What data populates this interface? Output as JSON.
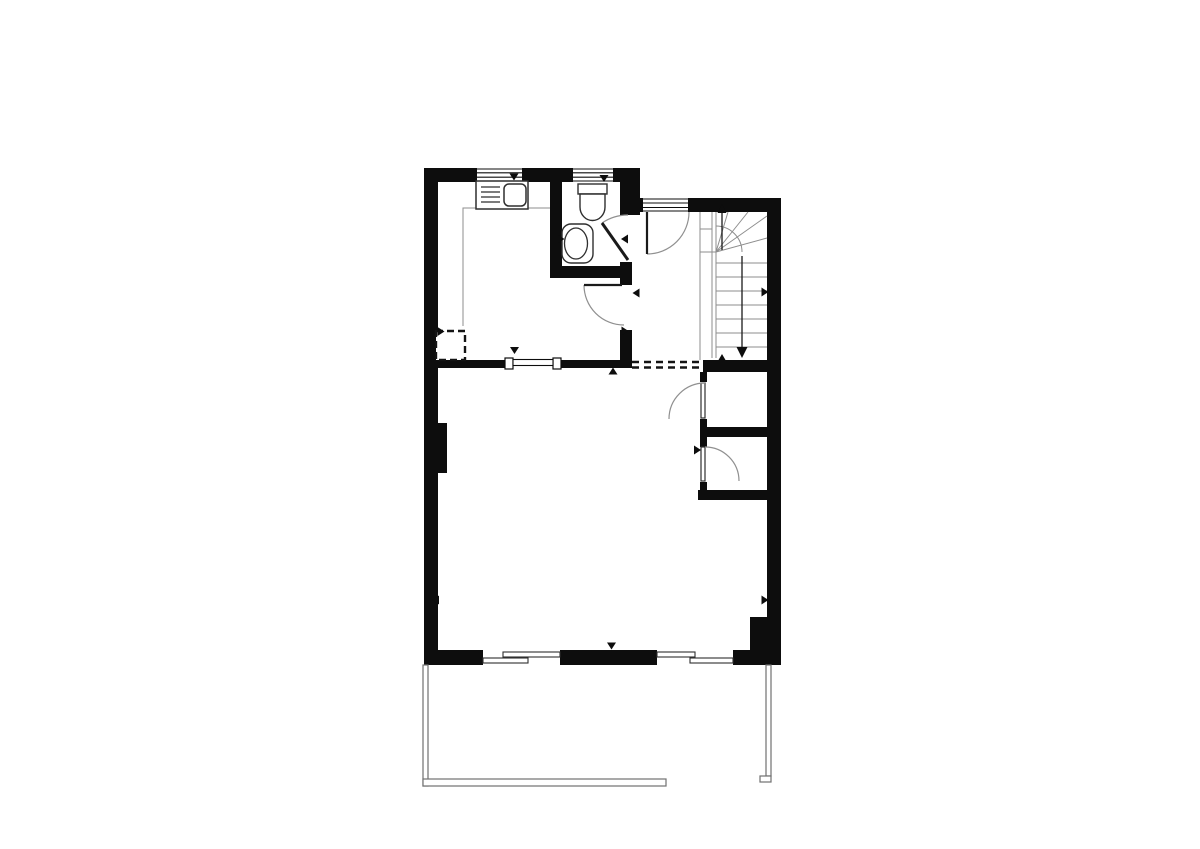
{
  "canvas": {
    "width": 1200,
    "height": 849,
    "background": "#ffffff"
  },
  "colors": {
    "wall": "#0d0d0d",
    "fixture": "#2f2f2f",
    "leaf": "#1a1a1a",
    "thin": "#8d8d8d",
    "arc": "#909090",
    "rail": "#707070",
    "dash": "#141414",
    "white": "#ffffff"
  },
  "floorplan": {
    "elements": [
      {
        "t": "rect",
        "n": "top-wall",
        "x": 424,
        "y": 168,
        "w": 214,
        "h": 14
      },
      {
        "t": "rect",
        "n": "left-wall",
        "x": 424,
        "y": 168,
        "w": 14,
        "h": 497
      },
      {
        "t": "rect",
        "n": "entry-junction-column",
        "x": 630,
        "y": 168,
        "w": 10,
        "h": 47
      },
      {
        "t": "rect",
        "n": "hallway-top-wall",
        "x": 640,
        "y": 198,
        "w": 141,
        "h": 14
      },
      {
        "t": "rect",
        "n": "right-wall",
        "x": 767,
        "y": 198,
        "w": 14,
        "h": 467
      },
      {
        "t": "rect",
        "n": "bottom-wall",
        "x": 424,
        "y": 650,
        "w": 357,
        "h": 15
      },
      {
        "t": "rect",
        "n": "corner-block",
        "x": 750,
        "y": 617,
        "w": 31,
        "h": 48
      },
      {
        "t": "rect",
        "n": "bathroom-left-wall",
        "x": 550,
        "y": 182,
        "w": 12,
        "h": 96
      },
      {
        "t": "rect",
        "n": "bathroom-bottom-wall",
        "x": 550,
        "y": 266,
        "w": 82,
        "h": 12
      },
      {
        "t": "rect",
        "n": "bathroom-right-wall",
        "x": 620,
        "y": 182,
        "w": 12,
        "h": 33
      },
      {
        "t": "rect",
        "n": "kitchen-hall-wall",
        "x": 620,
        "y": 262,
        "w": 12,
        "h": 100
      },
      {
        "t": "rect",
        "n": "kitchen-living-wall",
        "x": 424,
        "y": 360,
        "w": 208,
        "h": 8
      },
      {
        "t": "rect",
        "n": "stairs-bottom-wall",
        "x": 703,
        "y": 360,
        "w": 78,
        "h": 12
      },
      {
        "t": "rect",
        "n": "closet-left-wall",
        "x": 700,
        "y": 372,
        "w": 7,
        "h": 128
      },
      {
        "t": "rect",
        "n": "closet-mid-wall",
        "x": 700,
        "y": 427,
        "w": 67,
        "h": 10
      },
      {
        "t": "rect",
        "n": "closet-bottom-wall",
        "x": 698,
        "y": 490,
        "w": 69,
        "h": 10
      },
      {
        "t": "rect",
        "n": "left-wall-pier",
        "x": 433,
        "y": 423,
        "w": 14,
        "h": 50
      },
      {
        "t": "rect",
        "n": "window-1-gap",
        "x": 477,
        "y": 168,
        "w": 45,
        "h": 14,
        "f": "white"
      },
      {
        "t": "rect",
        "n": "window-2-gap",
        "x": 573,
        "y": 168,
        "w": 40,
        "h": 14,
        "f": "white"
      },
      {
        "t": "rect",
        "n": "entry-door-gap",
        "x": 643,
        "y": 198,
        "w": 45,
        "h": 14,
        "f": "white"
      },
      {
        "t": "rect",
        "n": "kitchen-opening-gap",
        "x": 505,
        "y": 360,
        "w": 56,
        "h": 8,
        "f": "white"
      },
      {
        "t": "rect",
        "n": "slider-1-gap",
        "x": 483,
        "y": 650,
        "w": 77,
        "h": 15,
        "f": "white"
      },
      {
        "t": "rect",
        "n": "slider-2-gap",
        "x": 657,
        "y": 650,
        "w": 76,
        "h": 15,
        "f": "white"
      },
      {
        "t": "rect",
        "n": "bathroom-door-gap",
        "x": 618,
        "y": 215,
        "w": 16,
        "h": 47,
        "f": "white"
      },
      {
        "t": "rect",
        "n": "hall-door-gap",
        "x": 618,
        "y": 285,
        "w": 16,
        "h": 45,
        "f": "white"
      },
      {
        "t": "rect",
        "n": "upper-closet-door-gap",
        "x": 698,
        "y": 382,
        "w": 11,
        "h": 37,
        "f": "white"
      },
      {
        "t": "rect",
        "n": "lower-closet-door-gap",
        "x": 698,
        "y": 447,
        "w": 11,
        "h": 35,
        "f": "white"
      },
      {
        "t": "path",
        "n": "window-1-frame",
        "d": "M477,169 H522 M477,181 H522 M477,172.8 H522 M477,177.2 H522",
        "s": "wall",
        "sw": 1.1
      },
      {
        "t": "path",
        "n": "window-2-frame",
        "d": "M573,169 H613 M573,181 H613 M573,172.8 H613 M573,177.2 H613",
        "s": "wall",
        "sw": 1.1
      },
      {
        "t": "path",
        "n": "entry-door-threshold",
        "d": "M643,199 H688 M643,211 H688 M643,203 H688 M643,207.5 H688",
        "s": "wall",
        "sw": 1.1
      },
      {
        "t": "rect",
        "n": "kitchen-opening-cap-left",
        "x": 505,
        "y": 358,
        "w": 8,
        "h": 11,
        "f": "white",
        "s": "wall",
        "sw": 1.2
      },
      {
        "t": "rect",
        "n": "kitchen-opening-cap-right",
        "x": 553,
        "y": 358,
        "w": 8,
        "h": 11,
        "f": "white",
        "s": "wall",
        "sw": 1.2
      },
      {
        "t": "rect",
        "n": "kitchen-opening-rail",
        "x": 513,
        "y": 359.5,
        "w": 40,
        "h": 6,
        "f": "white",
        "s": "wall",
        "sw": 1.1
      },
      {
        "t": "path",
        "n": "kitchen-zone-line",
        "d": "M463,326 V208 H550",
        "s": "thin",
        "sw": 1
      },
      {
        "t": "rect",
        "n": "kitchen-sink-unit",
        "x": 476,
        "y": 181,
        "w": 52,
        "h": 28,
        "f": "white",
        "s": "fixture",
        "sw": 1.5
      },
      {
        "t": "path",
        "n": "sink-drainer-lines",
        "d": "M481,187 H500 M481,192 H500 M481,197 H500 M481,202 H500",
        "s": "fixture",
        "sw": 1.3
      },
      {
        "t": "rect",
        "n": "sink-basin",
        "x": 504,
        "y": 184,
        "w": 22,
        "h": 22,
        "rx": 5,
        "f": "white",
        "s": "fixture",
        "sw": 1.5
      },
      {
        "t": "rect",
        "n": "toilet-tank",
        "x": 578,
        "y": 184,
        "w": 29,
        "h": 10,
        "f": "white",
        "s": "fixture",
        "sw": 1.4
      },
      {
        "t": "path",
        "n": "toilet-bowl",
        "d": "M580,194 h25 v13 a12.5,13.5 0 0 1 -25,0 z",
        "f": "white",
        "s": "fixture",
        "sw": 1.4
      },
      {
        "t": "rect",
        "n": "washbasin-counter",
        "x": 562,
        "y": 224,
        "w": 31,
        "h": 39,
        "rx": 9,
        "f": "white",
        "s": "fixture",
        "sw": 1.4
      },
      {
        "t": "ellipse",
        "n": "washbasin-bowl",
        "cx": 576,
        "cy": 243.5,
        "rx": 11.5,
        "ry": 15.5,
        "s": "fixture",
        "sw": 1.3
      },
      {
        "t": "path",
        "n": "bathroom-door-arc",
        "d": "M602,223 A46,46 0 0 1 628,215",
        "s": "arc",
        "sw": 1.2
      },
      {
        "t": "path",
        "n": "bathroom-door-leaf",
        "d": "M628,260 L602,223",
        "s": "leaf",
        "sw": 3
      },
      {
        "t": "path",
        "n": "hall-kitchen-door-arc",
        "d": "M584,285 A40,40 0 0 0 624,325",
        "s": "arc",
        "sw": 1.2
      },
      {
        "t": "path",
        "n": "hall-kitchen-door-leaf",
        "d": "M622,285 H584",
        "s": "leaf",
        "sw": 2.2
      },
      {
        "t": "path",
        "n": "entry-door-arc",
        "d": "M647,254 A42,42 0 0 0 689,212",
        "s": "arc",
        "sw": 1.2
      },
      {
        "t": "path",
        "n": "entry-door-leaf",
        "d": "M647,212 V254",
        "s": "leaf",
        "sw": 2.2
      },
      {
        "t": "path",
        "n": "stairs-winder-box",
        "d": "M700,212 V360 M700,229 H712 M700,252 H716",
        "s": "thin",
        "sw": 1
      },
      {
        "t": "path",
        "n": "stairs-stringer",
        "d": "M712,212 V358 M716,212 V358",
        "s": "thin",
        "sw": 1
      },
      {
        "t": "path",
        "n": "stairs-treads",
        "d": "M716,263 H767 M716,277 H767 M716,291 H767 M716,305 H767 M716,319 H767 M716,333 H767 M716,347 H767",
        "s": "thin",
        "sw": 1.1
      },
      {
        "t": "path",
        "n": "stairs-winder-radials",
        "d": "M716,252 L728,212 M716,252 L748,212 M716,252 L767,216 M716,252 L767,238",
        "s": "thin",
        "sw": 1
      },
      {
        "t": "path",
        "n": "stairs-winder-arc",
        "d": "M716,226 A26,26 0 0 1 742,252",
        "s": "thin",
        "sw": 1
      },
      {
        "t": "path",
        "n": "stairs-up-walkline",
        "d": "M722,213 V250",
        "s": "leaf",
        "sw": 1.3
      },
      {
        "t": "path",
        "n": "stairs-down-walkline",
        "d": "M742,256 V348",
        "s": "leaf",
        "sw": 1.3
      },
      {
        "t": "path",
        "n": "under-stairs-opening-dashes",
        "d": "M632,362 H701 M632,367.5 H701",
        "s": "dash",
        "sw": 2.4,
        "da": "7,5"
      },
      {
        "t": "path",
        "n": "kitchen-dashed-appliance",
        "d": "M436,331 h29 v29 h-29 z",
        "f": "white",
        "s": "dash",
        "sw": 2.4,
        "da": "7,4"
      },
      {
        "t": "rect",
        "n": "upper-closet-door-leaf",
        "x": 701,
        "y": 383,
        "w": 4,
        "h": 35,
        "f": "white",
        "s": "fixture",
        "sw": 1.2
      },
      {
        "t": "path",
        "n": "upper-closet-door-arc",
        "d": "M705,383 A36,36 0 0 0 669,419",
        "s": "arc",
        "sw": 1.2
      },
      {
        "t": "rect",
        "n": "lower-closet-door-leaf",
        "x": 701,
        "y": 447,
        "w": 4,
        "h": 34,
        "f": "white",
        "s": "fixture",
        "sw": 1.2
      },
      {
        "t": "path",
        "n": "lower-closet-door-arc",
        "d": "M705,447 A34,34 0 0 1 739,481",
        "s": "arc",
        "sw": 1.2
      },
      {
        "t": "rect",
        "n": "slider-1-panel-a",
        "x": 503,
        "y": 652,
        "w": 57,
        "h": 5,
        "f": "white",
        "s": "fixture",
        "sw": 1.1
      },
      {
        "t": "rect",
        "n": "slider-1-panel-b",
        "x": 483,
        "y": 658,
        "w": 45,
        "h": 5,
        "f": "white",
        "s": "fixture",
        "sw": 1.1
      },
      {
        "t": "rect",
        "n": "slider-2-panel-a",
        "x": 657,
        "y": 652,
        "w": 38,
        "h": 5,
        "f": "white",
        "s": "fixture",
        "sw": 1.1
      },
      {
        "t": "rect",
        "n": "slider-2-panel-b",
        "x": 690,
        "y": 658,
        "w": 43,
        "h": 5,
        "f": "white",
        "s": "fixture",
        "sw": 1.1
      },
      {
        "t": "rect",
        "n": "terrace-left-rail",
        "x": 423,
        "y": 665,
        "w": 5,
        "h": 121,
        "f": "white",
        "s": "rail",
        "sw": 1.2
      },
      {
        "t": "rect",
        "n": "terrace-bottom-rail",
        "x": 423,
        "y": 779,
        "w": 243,
        "h": 7,
        "f": "white",
        "s": "rail",
        "sw": 1.2
      },
      {
        "t": "rect",
        "n": "terrace-right-rail",
        "x": 766,
        "y": 665,
        "w": 5,
        "h": 111,
        "f": "white",
        "s": "rail",
        "sw": 1.2
      },
      {
        "t": "rect",
        "n": "terrace-right-rail-foot",
        "x": 760,
        "y": 776,
        "w": 11,
        "h": 6,
        "f": "white",
        "s": "rail",
        "sw": 1.2
      },
      {
        "t": "tri",
        "n": "window-1-marker",
        "x": 514,
        "y": 177,
        "dir": "down",
        "w": 9,
        "h": 7
      },
      {
        "t": "tri",
        "n": "window-2-marker",
        "x": 604,
        "y": 178.5,
        "dir": "down",
        "w": 9,
        "h": 7
      },
      {
        "t": "tri",
        "n": "washbasin-marker",
        "x": 561,
        "y": 239,
        "dir": "right",
        "w": 7,
        "h": 9
      },
      {
        "t": "tri",
        "n": "bathroom-door-marker",
        "x": 624.5,
        "y": 239,
        "dir": "left",
        "w": 7,
        "h": 9
      },
      {
        "t": "tri",
        "n": "hallway-door-marker",
        "x": 636,
        "y": 293,
        "dir": "left",
        "w": 7,
        "h": 9
      },
      {
        "t": "tri",
        "n": "kitchen-door-marker",
        "x": 625,
        "y": 331,
        "dir": "right",
        "w": 7,
        "h": 9
      },
      {
        "t": "tri",
        "n": "kitchen-wall-marker",
        "x": 613,
        "y": 371,
        "dir": "up",
        "w": 9,
        "h": 7
      },
      {
        "t": "tri",
        "n": "kitchen-opening-marker",
        "x": 514.5,
        "y": 350.5,
        "dir": "down",
        "w": 9,
        "h": 7
      },
      {
        "t": "tri",
        "n": "kitchen-corner-marker",
        "x": 441,
        "y": 331.5,
        "dir": "right",
        "w": 7,
        "h": 9
      },
      {
        "t": "tri",
        "n": "left-wall-marker",
        "x": 435.5,
        "y": 600,
        "dir": "left",
        "w": 7,
        "h": 9
      },
      {
        "t": "tri",
        "n": "right-wall-marker",
        "x": 765,
        "y": 600,
        "dir": "right",
        "w": 7,
        "h": 9
      },
      {
        "t": "tri",
        "n": "stairs-wall-marker",
        "x": 765,
        "y": 292,
        "dir": "right",
        "w": 7,
        "h": 9
      },
      {
        "t": "tri",
        "n": "closet-door-marker",
        "x": 697.5,
        "y": 450,
        "dir": "right",
        "w": 7,
        "h": 9
      },
      {
        "t": "tri",
        "n": "bottom-wall-marker",
        "x": 611.5,
        "y": 646,
        "dir": "down",
        "w": 9,
        "h": 7
      },
      {
        "t": "tri",
        "n": "stairs-up-arrowhead",
        "x": 722,
        "y": 208.5,
        "dir": "up",
        "w": 9,
        "h": 9
      },
      {
        "t": "tri",
        "n": "stairs-down-arrowhead",
        "x": 742,
        "y": 352.5,
        "dir": "down",
        "w": 11,
        "h": 11
      },
      {
        "t": "tri",
        "n": "stairs-base-marker",
        "x": 722,
        "y": 357,
        "dir": "up",
        "w": 7,
        "h": 6
      }
    ]
  }
}
